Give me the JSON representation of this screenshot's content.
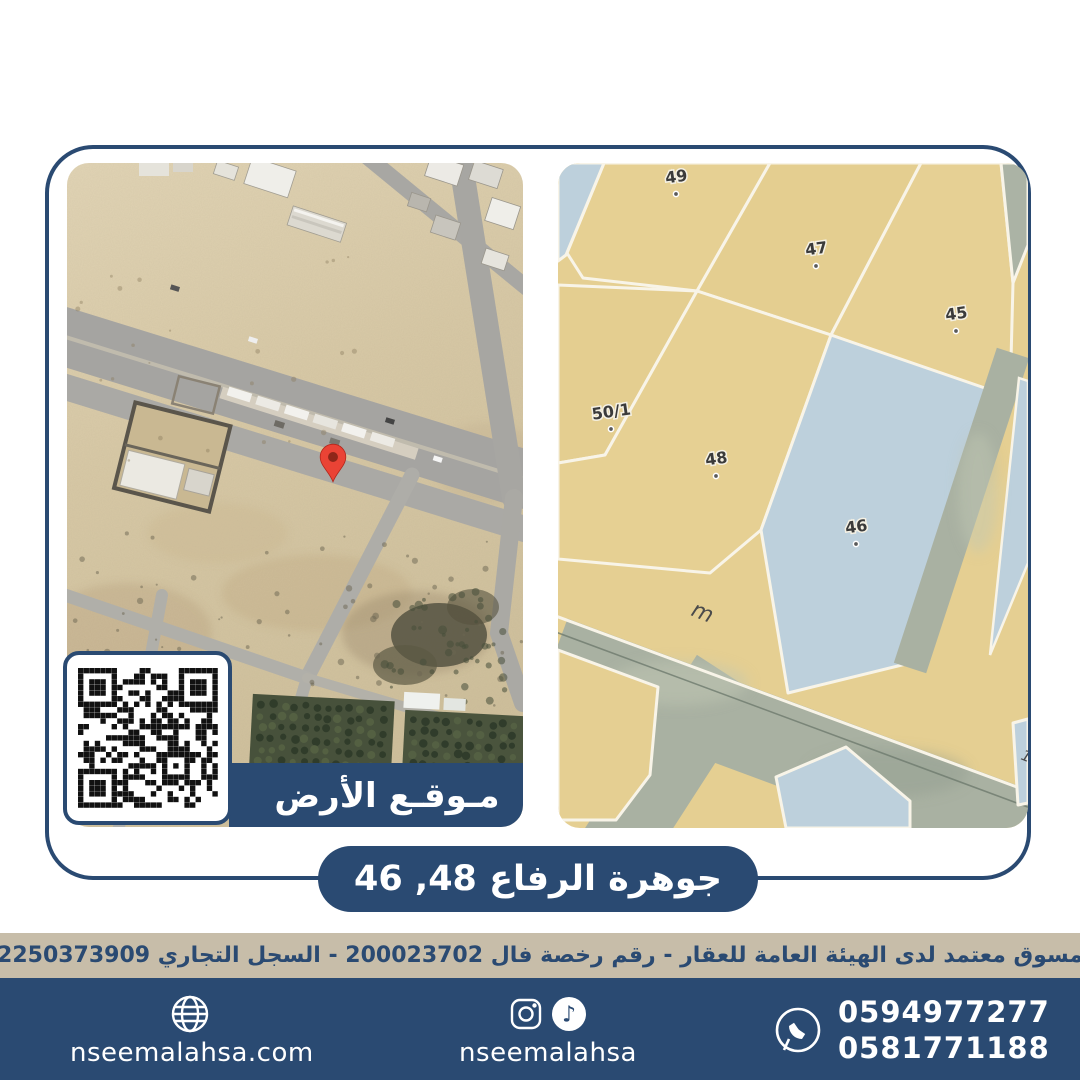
{
  "brand": {
    "navy": "#2a4a72",
    "beige": "#c7bda9",
    "parcel_tan": "#e5cf92",
    "parcel_blue": "#bdd0dc",
    "pin_red": "#ea4335"
  },
  "title_banner": {
    "text": "جوهرة الرفاع 48, 46"
  },
  "left_map": {
    "type": "satellite-photo",
    "location_label": "مـوقـع الأرض",
    "pin": "red-location-pin",
    "qr": "qr-code"
  },
  "right_map": {
    "type": "parcel-plan",
    "parcels": [
      {
        "id": "49"
      },
      {
        "id": "47"
      },
      {
        "id": "45"
      },
      {
        "id": "50/1"
      },
      {
        "id": "48"
      },
      {
        "id": "46"
      }
    ],
    "street_label": "m",
    "partial_label": "18"
  },
  "license_bar": {
    "text": "مسوق معتمد لدى الهيئة العامة للعقار - رقم رخصة فال 200023702 - السجل التجاري 2250373909"
  },
  "footer": {
    "website": "nseemalahsa.com",
    "social_handle": "nseemalahsa",
    "phones": [
      "0594977277",
      "0581771188"
    ]
  }
}
